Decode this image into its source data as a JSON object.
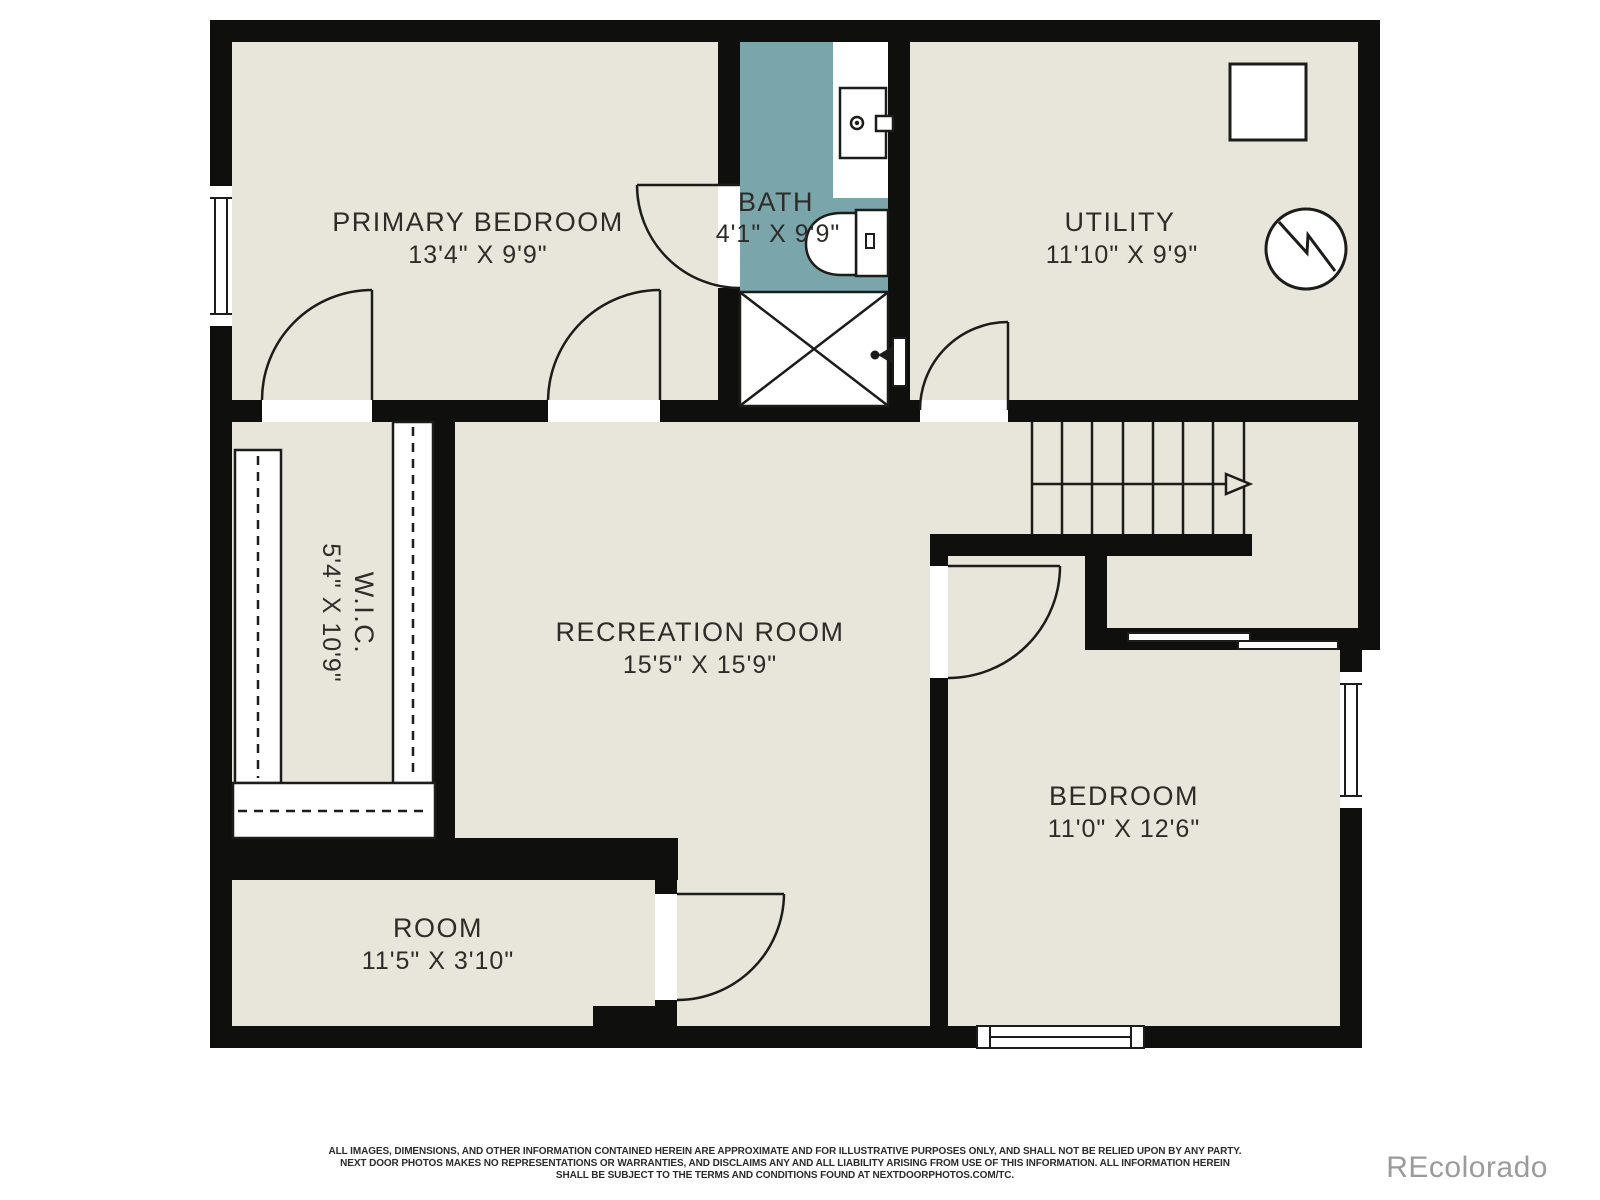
{
  "plan": {
    "rooms": {
      "primary_bedroom": {
        "name": "PRIMARY BEDROOM",
        "dims": "13'4\" X 9'9\""
      },
      "bath": {
        "name": "BATH",
        "dims": "4'1\" X 9'9\""
      },
      "utility": {
        "name": "UTILITY",
        "dims": "11'10\" X 9'9\""
      },
      "wic": {
        "name": "W.I.C.",
        "dims": "5'4\" X 10'9\""
      },
      "recreation_room": {
        "name": "RECREATION ROOM",
        "dims": "15'5\" X 15'9\""
      },
      "bedroom": {
        "name": "BEDROOM",
        "dims": "11'0\" X 12'6\""
      },
      "room": {
        "name": "ROOM",
        "dims": "11'5\" X 3'10\""
      }
    },
    "colors": {
      "floor": "#e8e6da",
      "wall": "#0f0f0e",
      "bath_floor": "#7aa6ab",
      "line": "#1c1c1a",
      "label": "#2d2c29",
      "watermark": "#9b9b9b"
    }
  },
  "footer": {
    "disclaimer_line1": "ALL IMAGES, DIMENSIONS, AND OTHER INFORMATION CONTAINED HEREIN ARE APPROXIMATE AND FOR ILLUSTRATIVE PURPOSES ONLY, AND SHALL NOT BE RELIED UPON BY ANY PARTY.",
    "disclaimer_line2": "NEXT DOOR PHOTOS MAKES NO REPRESENTATIONS OR WARRANTIES, AND DISCLAIMS ANY AND ALL LIABILITY ARISING FROM USE OF THIS INFORMATION. ALL INFORMATION HEREIN",
    "disclaimer_line3": "SHALL BE SUBJECT TO THE TERMS AND CONDITIONS FOUND AT NEXTDOORPHOTOS.COM/TC.",
    "watermark": "REcolorado"
  }
}
